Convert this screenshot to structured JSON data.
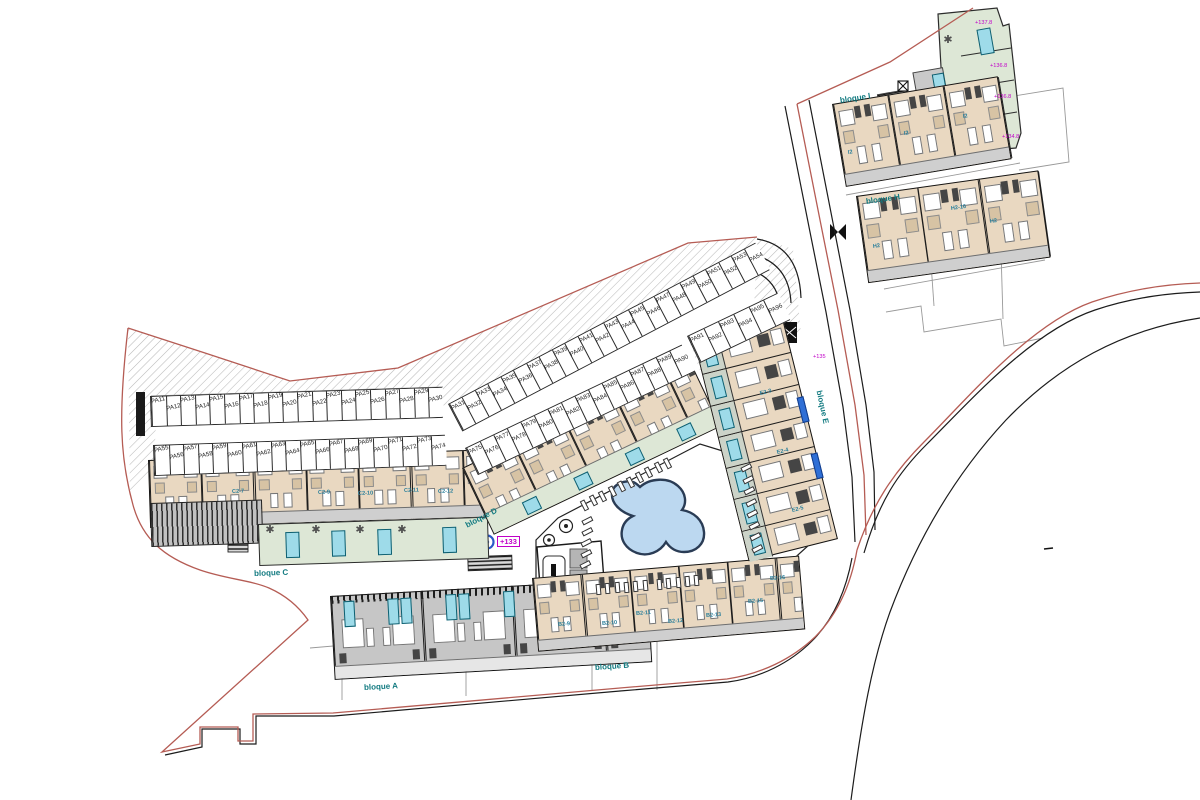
{
  "title": "Residential site plan with bloques A-I, parking and pool",
  "parking": {
    "rowA": [
      "PA11",
      "PA12",
      "PA13",
      "PA14",
      "PA15",
      "PA16",
      "PA17",
      "PA18",
      "PA19",
      "PA20",
      "PA21",
      "PA22",
      "PA23",
      "PA24",
      "PA25",
      "PA26",
      "PA27",
      "PA28",
      "PA29",
      "PA30"
    ],
    "rowB": [
      "PA55",
      "PA56",
      "PA57",
      "PA58",
      "PA59",
      "PA60",
      "PA61",
      "PA62",
      "PA63",
      "PA64",
      "PA65",
      "PA66",
      "PA67",
      "PA68",
      "PA69",
      "PA70",
      "PA71",
      "PA72",
      "PA73",
      "PA74"
    ],
    "rowC": [
      "PA31",
      "PA32",
      "PA33",
      "PA34",
      "PA35",
      "PA36",
      "PA37",
      "PA38",
      "PA39",
      "PA40",
      "PA41",
      "PA42",
      "PA43",
      "PA44",
      "PA45",
      "PA46",
      "PA47",
      "PA48",
      "PA49",
      "PA50",
      "PA51",
      "PA52",
      "PA53",
      "PA54"
    ],
    "rowD": [
      "PA75",
      "PA76",
      "PA77",
      "PA78",
      "PA79",
      "PA80",
      "PA81",
      "PA82",
      "PA83",
      "PA84",
      "PA85",
      "PA86",
      "PA87",
      "PA88",
      "PA89",
      "PA90"
    ],
    "rowE": [
      "PA91",
      "PA92",
      "PA93",
      "PA94",
      "PA95",
      "PA96"
    ]
  },
  "labels": {
    "blocks": [
      {
        "text": "bloque A",
        "x": 364,
        "y": 683,
        "rot": -3
      },
      {
        "text": "bloque B",
        "x": 595,
        "y": 663,
        "rot": -4
      },
      {
        "text": "bloque C",
        "x": 254,
        "y": 569,
        "rot": -2
      },
      {
        "text": "bloque D",
        "x": 466,
        "y": 521,
        "rot": -27
      },
      {
        "text": "bloque E",
        "x": 819,
        "y": 386,
        "rot": 78
      },
      {
        "text": "bloque H",
        "x": 866,
        "y": 197,
        "rot": -8
      },
      {
        "text": "bloque I",
        "x": 840,
        "y": 96,
        "rot": -9
      }
    ],
    "units": [
      {
        "text": "C2-7",
        "x": 232,
        "y": 489,
        "rot": -2
      },
      {
        "text": "C2-9",
        "x": 318,
        "y": 490,
        "rot": -2
      },
      {
        "text": "C2-10",
        "x": 358,
        "y": 491,
        "rot": -2
      },
      {
        "text": "C2-11",
        "x": 404,
        "y": 488,
        "rot": -2
      },
      {
        "text": "C2-12",
        "x": 438,
        "y": 489,
        "rot": -2
      },
      {
        "text": "B2-9",
        "x": 558,
        "y": 622,
        "rot": -4
      },
      {
        "text": "B2-10",
        "x": 602,
        "y": 621,
        "rot": -4
      },
      {
        "text": "B2-11",
        "x": 636,
        "y": 611,
        "rot": -4
      },
      {
        "text": "B2-12",
        "x": 668,
        "y": 619,
        "rot": -4
      },
      {
        "text": "B2-13",
        "x": 706,
        "y": 613,
        "rot": -4
      },
      {
        "text": "B2-15",
        "x": 748,
        "y": 599,
        "rot": -4
      },
      {
        "text": "B2-16",
        "x": 770,
        "y": 576,
        "rot": -4
      },
      {
        "text": "E2-3",
        "x": 760,
        "y": 391,
        "rot": -14
      },
      {
        "text": "E2-4",
        "x": 777,
        "y": 450,
        "rot": -14
      },
      {
        "text": "E2-5",
        "x": 792,
        "y": 508,
        "rot": -14
      },
      {
        "text": "I2",
        "x": 848,
        "y": 150,
        "rot": -9
      },
      {
        "text": "I2",
        "x": 904,
        "y": 131,
        "rot": -9
      },
      {
        "text": "I2",
        "x": 963,
        "y": 114,
        "rot": -9
      },
      {
        "text": "H2",
        "x": 873,
        "y": 244,
        "rot": -8
      },
      {
        "text": "H2-16",
        "x": 951,
        "y": 206,
        "rot": -8
      },
      {
        "text": "H2",
        "x": 990,
        "y": 219,
        "rot": -8
      }
    ],
    "elevations": [
      {
        "text": "+133",
        "x": 497,
        "y": 536,
        "boxed": true
      },
      {
        "text": "+135",
        "x": 813,
        "y": 354,
        "boxed": false
      },
      {
        "text": "+137.8",
        "x": 975,
        "y": 20,
        "boxed": false
      },
      {
        "text": "+136.8",
        "x": 990,
        "y": 63,
        "boxed": false
      },
      {
        "text": "+136.8",
        "x": 994,
        "y": 94,
        "boxed": false
      },
      {
        "text": "+134.8",
        "x": 1002,
        "y": 134,
        "boxed": false
      }
    ]
  },
  "colors": {
    "boundary": "#b55c54",
    "hatch": "#b9b9b9",
    "beige": "#e9d8c1",
    "terrace_green": "#dde7d6",
    "pool_cyan": "#9edbe9",
    "pool_blue": "#bcd8f0",
    "pool_outline": "#2a3c55",
    "roof_gray": "#c6c6c6",
    "label_teal": "#117a80",
    "label_magenta": "#c100c8",
    "road_black": "#1c1c1c",
    "plot_gray": "#999999",
    "blue_bar": "#2f6fd6"
  }
}
